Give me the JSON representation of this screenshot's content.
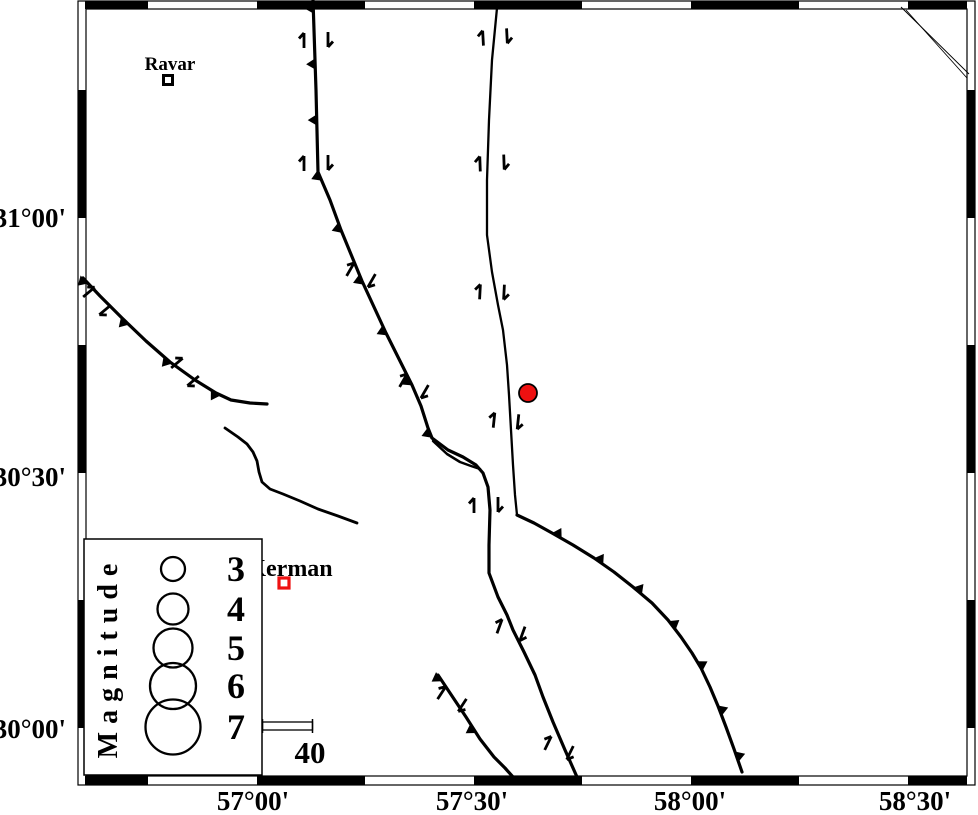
{
  "figure": {
    "width": 978,
    "height": 815,
    "background": "#ffffff",
    "ink_color": "#000000",
    "red_color": "#ee1111"
  },
  "frame": {
    "outer": {
      "x": 78,
      "y": 1,
      "w": 897,
      "h": 784
    },
    "inner": {
      "x": 86,
      "y": 9,
      "w": 881,
      "h": 767
    },
    "horizontal_black_segments": [
      [
        85,
        148
      ],
      [
        257,
        365
      ],
      [
        474,
        582
      ],
      [
        691,
        799
      ],
      [
        908,
        967
      ]
    ],
    "vertical_black_segments": [
      [
        90,
        218
      ],
      [
        345,
        473
      ],
      [
        600,
        728
      ]
    ]
  },
  "axes": {
    "left": [
      {
        "text": "31°00'",
        "y": 218
      },
      {
        "text": "30°30'",
        "y": 477
      },
      {
        "text": "30°00'",
        "y": 729
      }
    ],
    "bottom": [
      {
        "text": "57°00'",
        "x": 253
      },
      {
        "text": "57°30'",
        "x": 472
      },
      {
        "text": "58°00'",
        "x": 690
      },
      {
        "text": "58°30'",
        "x": 915
      }
    ],
    "font_size": 27
  },
  "faults": [
    {
      "id": "north-trending-thrust-west",
      "width": 3.2,
      "points": [
        [
          313,
          0
        ],
        [
          316,
          90
        ],
        [
          318,
          172
        ],
        [
          330,
          200
        ],
        [
          341,
          230
        ],
        [
          362,
          281
        ],
        [
          386,
          333
        ],
        [
          403,
          367
        ],
        [
          412,
          385
        ],
        [
          421,
          406
        ],
        [
          428,
          428
        ],
        [
          432,
          438
        ]
      ],
      "teeth": {
        "side": "right",
        "spacing": 56,
        "size": 9,
        "offset": 8
      }
    },
    {
      "id": "central-fault-south-segment",
      "width": 3.2,
      "points": [
        [
          432,
          438
        ],
        [
          448,
          450
        ],
        [
          463,
          457
        ],
        [
          476,
          465
        ],
        [
          483,
          473
        ],
        [
          488,
          487
        ],
        [
          490,
          510
        ],
        [
          489,
          545
        ],
        [
          489,
          573
        ],
        [
          498,
          597
        ],
        [
          507,
          615
        ],
        [
          513,
          630
        ],
        [
          524,
          652
        ],
        [
          535,
          675
        ],
        [
          543,
          697
        ],
        [
          553,
          722
        ],
        [
          565,
          750
        ],
        [
          577,
          777
        ]
      ],
      "teeth": null
    },
    {
      "id": "central-fault-splay",
      "width": 2.5,
      "points": [
        [
          433,
          441
        ],
        [
          447,
          454
        ],
        [
          460,
          462
        ],
        [
          471,
          466
        ],
        [
          480,
          469
        ]
      ],
      "teeth": null
    },
    {
      "id": "east-strike-slip-fault",
      "width": 2.3,
      "points": [
        [
          497,
          8
        ],
        [
          492,
          60
        ],
        [
          489,
          120
        ],
        [
          487,
          180
        ],
        [
          487,
          235
        ],
        [
          492,
          272
        ],
        [
          498,
          305
        ],
        [
          503,
          330
        ],
        [
          507,
          365
        ],
        [
          509,
          395
        ],
        [
          511,
          430
        ],
        [
          513,
          465
        ],
        [
          515,
          495
        ],
        [
          517,
          515
        ]
      ],
      "teeth": null
    },
    {
      "id": "southeast-thrust-arc",
      "width": 3.2,
      "points": [
        [
          517,
          515
        ],
        [
          534,
          523
        ],
        [
          552,
          533
        ],
        [
          573,
          545
        ],
        [
          594,
          558
        ],
        [
          614,
          572
        ],
        [
          633,
          587
        ],
        [
          652,
          603
        ],
        [
          668,
          620
        ],
        [
          681,
          637
        ],
        [
          692,
          653
        ],
        [
          701,
          668
        ],
        [
          710,
          687
        ],
        [
          718,
          706
        ],
        [
          726,
          727
        ],
        [
          734,
          749
        ],
        [
          742,
          772
        ]
      ],
      "teeth": {
        "side": "left",
        "spacing": 49,
        "size": 9,
        "offset": 45
      }
    },
    {
      "id": "northwest-thrust",
      "width": 3.2,
      "points": [
        [
          83,
          278
        ],
        [
          100,
          296
        ],
        [
          122,
          318
        ],
        [
          146,
          341
        ],
        [
          170,
          362
        ],
        [
          195,
          380
        ],
        [
          216,
          393
        ],
        [
          231,
          400
        ],
        [
          250,
          403
        ],
        [
          267,
          404
        ]
      ],
      "teeth": {
        "side": "right",
        "spacing": 58,
        "size": 9,
        "offset": 2
      }
    },
    {
      "id": "southwest-short-thrust",
      "width": 3.2,
      "points": [
        [
          438,
          675
        ],
        [
          452,
          696
        ],
        [
          466,
          717
        ],
        [
          480,
          739
        ],
        [
          494,
          757
        ],
        [
          505,
          768
        ],
        [
          513,
          777
        ]
      ],
      "teeth": {
        "side": "right",
        "spacing": 62,
        "size": 9,
        "offset": 2
      }
    },
    {
      "id": "west-curved-lineament",
      "width": 2.8,
      "points": [
        [
          225,
          428
        ],
        [
          238,
          437
        ],
        [
          247,
          444
        ],
        [
          253,
          452
        ],
        [
          257,
          461
        ],
        [
          259,
          472
        ],
        [
          262,
          482
        ],
        [
          270,
          489
        ],
        [
          283,
          494
        ],
        [
          300,
          501
        ],
        [
          318,
          509
        ],
        [
          338,
          516
        ],
        [
          357,
          523
        ]
      ],
      "teeth": null
    }
  ],
  "corner_lines": [
    [
      [
        901,
        7
      ],
      [
        969,
        74
      ]
    ],
    [
      [
        906,
        10
      ],
      [
        967,
        78
      ]
    ]
  ],
  "slip_arrow_pairs": [
    {
      "x": 316,
      "y": 40,
      "angle": 0
    },
    {
      "x": 316,
      "y": 163,
      "angle": 0
    },
    {
      "x": 361,
      "y": 275,
      "angle": 30
    },
    {
      "x": 414,
      "y": 386,
      "angle": 30
    },
    {
      "x": 495,
      "y": 37,
      "angle": -3
    },
    {
      "x": 492,
      "y": 163,
      "angle": -2
    },
    {
      "x": 492,
      "y": 292,
      "angle": 3
    },
    {
      "x": 506,
      "y": 421,
      "angle": 6
    },
    {
      "x": 486,
      "y": 505,
      "angle": 0
    },
    {
      "x": 511,
      "y": 630,
      "angle": 20
    },
    {
      "x": 559,
      "y": 748,
      "angle": 26
    },
    {
      "x": 97,
      "y": 301,
      "angle": 50
    },
    {
      "x": 185,
      "y": 372,
      "angle": 50
    },
    {
      "x": 452,
      "y": 699,
      "angle": 33
    }
  ],
  "towns": [
    {
      "name": "Ravar",
      "marker_x": 168,
      "marker_y": 80,
      "marker_size": 9,
      "marker_stroke": 3,
      "marker_color": "#000000",
      "label_x": 170,
      "label_y": 70,
      "font_size": 19
    },
    {
      "name": "Kerman",
      "marker_x": 284,
      "marker_y": 583,
      "marker_size": 10,
      "marker_stroke": 3.2,
      "marker_color": "#ee1111",
      "label_x": 290,
      "label_y": 576,
      "font_size": 24
    }
  ],
  "epicenter": {
    "x": 528,
    "y": 393,
    "radius": 9,
    "fill": "#ee1111",
    "stroke": "#000000",
    "stroke_width": 1.8
  },
  "legend": {
    "title": "Magnitude",
    "title_x": 117,
    "title_y": 657,
    "title_font_size": 28,
    "title_letter_spacing": 8,
    "box": {
      "x": 84,
      "y": 539,
      "w": 178,
      "h": 236
    },
    "circle_x": 173,
    "label_x": 227,
    "label_font_size": 36,
    "entries": [
      {
        "label": "3",
        "y": 569,
        "r": 12
      },
      {
        "label": "4",
        "y": 609,
        "r": 15.5
      },
      {
        "label": "5",
        "y": 648,
        "r": 19.5
      },
      {
        "label": "6",
        "y": 686,
        "r": 23
      },
      {
        "label": "7",
        "y": 727,
        "r": 27.5
      }
    ]
  },
  "scale_bar": {
    "x1": 262.5,
    "x2": 312.5,
    "y": 722,
    "h": 8,
    "tick_top": 719,
    "tick_bottom": 733,
    "label": "40",
    "label_x": 310,
    "label_y": 763,
    "label_font_size": 31
  }
}
